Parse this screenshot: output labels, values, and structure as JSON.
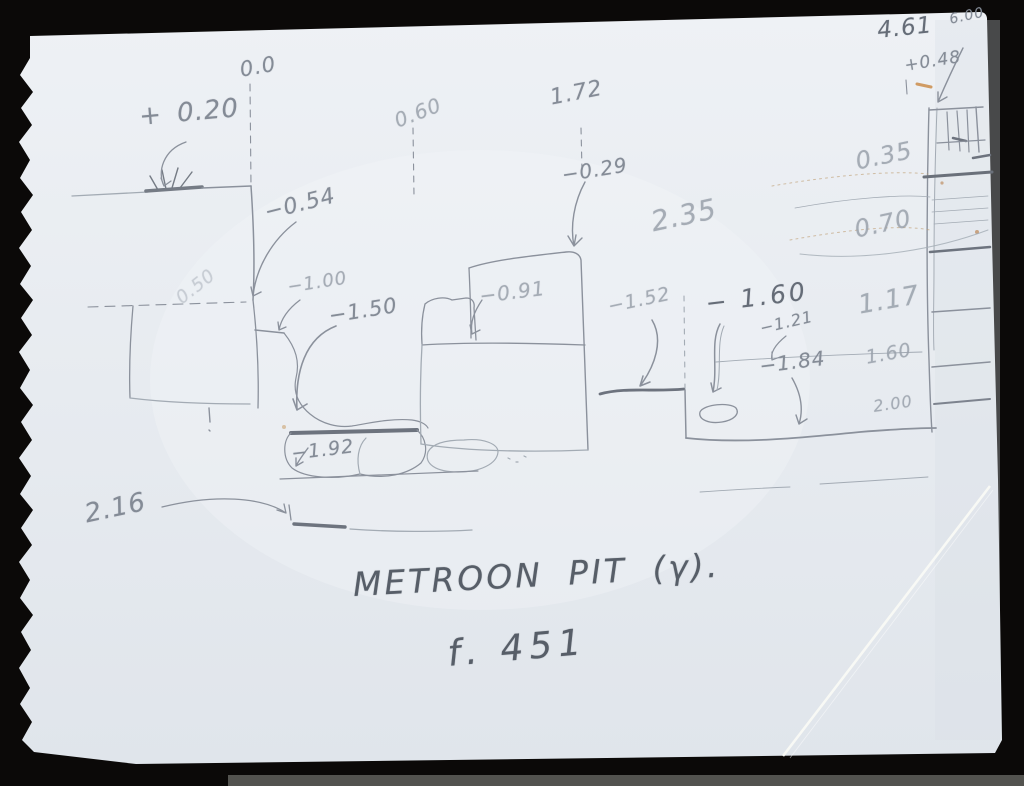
{
  "photo": {
    "description_colors": {
      "background": "#0b0908",
      "paper": "#e8ecf1",
      "pencil": "#848b96"
    },
    "sketch": {
      "title": "METROON PIT (γ).",
      "folio": "f. 451",
      "annotations": {
        "datum": "0.0",
        "plus_020": "+ 0.20",
        "d_060": "0.60",
        "d_172": "1.72",
        "m_054": "−0.54",
        "m_029": "−0.29",
        "m_100": "−1.00",
        "m_150": "−1.50",
        "d_235": "2.35",
        "m_091": "−0.91",
        "m_152": "−1.52",
        "m_160": "− 1.60",
        "d_117": "1.17",
        "m_121": "−1.21",
        "m_184": "−1.84",
        "d_160": "1.60",
        "d_200": "2.00",
        "m_192": "−1.92",
        "d_216": "2.16",
        "d_461": "4.61",
        "d_600": "6.00",
        "plus_048": "+0.48",
        "d_035": "0.35",
        "d_070": "0.70",
        "faint_050": "0.50"
      }
    }
  }
}
